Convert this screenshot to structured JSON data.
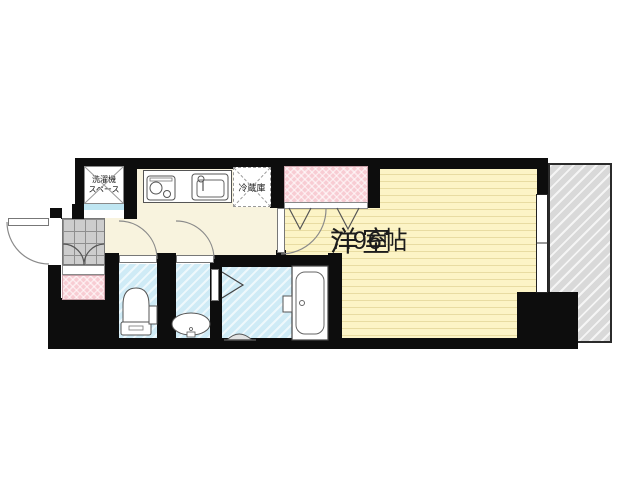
{
  "rooms": {
    "western_room": {
      "name": "洋室",
      "size": "7.96帖"
    },
    "washer_space": {
      "line1": "洗濯機",
      "line2": "スペース"
    },
    "fridge": {
      "label": "冷蔵庫"
    }
  },
  "colors": {
    "wall": "#0d0d0d",
    "room_floor": "#fcf4c6",
    "room_floor_line": "#e8dca2",
    "hall_floor": "#f8f3de",
    "closet_pink": "#f8ccd3",
    "wet_blue": "#cfebf6",
    "tile_gray": "#cdcdcd",
    "balcony_gray": "#d9d9d9",
    "accent_cyan": "#bfe6f2"
  }
}
